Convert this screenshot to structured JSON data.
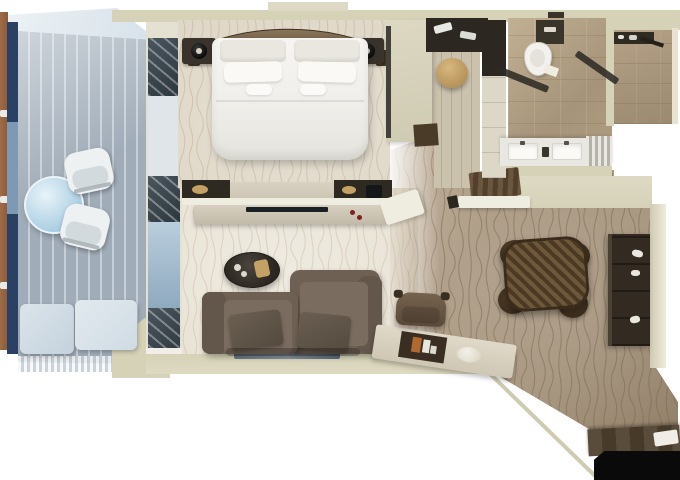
{
  "scene": {
    "type": "floor-plan",
    "subject": "one-bedroom suite floor plan, top-down 3D rendering",
    "rooms": [
      {
        "name": "balcony",
        "furniture": [
          "round-glass-table",
          "armchair",
          "armchair",
          "lounger-cushions",
          "plank-decking",
          "railing",
          "awning"
        ]
      },
      {
        "name": "bedroom",
        "furniture": [
          "double-bed",
          "curved-headboard",
          "pillows",
          "nightstand-left",
          "nightstand-right",
          "table-lamps",
          "dresser-console"
        ]
      },
      {
        "name": "walk-in-closet",
        "furniture": [
          "wardrobe-shelf",
          "round-ottoman",
          "wood-floor",
          "closet-doors"
        ]
      },
      {
        "name": "bathroom",
        "furniture": [
          "toilet",
          "double-vanity",
          "glass-shower-partitions",
          "shower-room",
          "shower-fittings"
        ]
      },
      {
        "name": "living-room",
        "furniture": [
          "media-console",
          "tv",
          "oval-coffee-table",
          "two-seat-sofa",
          "throw-pillows",
          "writing-desk",
          "desk-chair",
          "serving-tray"
        ]
      },
      {
        "name": "dining-area",
        "furniture": [
          "round-dining-table",
          "dining-chair",
          "dining-chair",
          "dining-chair",
          "dining-chair",
          "bar-cabinet"
        ]
      },
      {
        "name": "entry",
        "furniture": [
          "wood-threshold",
          "door-mat",
          "doorway"
        ]
      }
    ]
  },
  "palette": {
    "white": "#ffffff",
    "wall": "#d6d2b8",
    "wall_light": "#ddd9c4",
    "awning": "#edf2f5",
    "railing": "#a06c48",
    "door_blue": "#2b4163",
    "glass_mid": "#7d99b4",
    "deck": "#a0acb8",
    "deck_light": "#c6cfd7",
    "glass_table_hi": "#e8f3f9",
    "glass_table": "#a9cde2",
    "chair_white": "#eef1f2",
    "chair_seat": "#d3dade",
    "lounger_a": "#c4d2dd",
    "lounger_b": "#cfdbe4",
    "win_dark_a": "#4a565e",
    "win_dark_b": "#2c363d",
    "win_glass": "#dfe5e8",
    "win_blue_a": "#b9cedd",
    "win_blue_b": "#8fa9bf",
    "sill": "#f0eee6",
    "bedroom_carpet": "#ded6c5",
    "bedroom_wave": "#bfb099",
    "living_carpet": "#e8e2d4",
    "living_wave": "#cbbda6",
    "corridor_a": "#c4b39d",
    "corridor_b": "#a5937c",
    "corridor_wave": "#79684f",
    "headboard_a": "#8a7659",
    "headboard_b": "#4e3f2c",
    "nightstand": "#3a332b",
    "lamp_hi": "#d9d2c4",
    "bed_hi": "#f6f5f2",
    "bed_lo": "#e5e3dc",
    "pillow_hi": "#faf9f6",
    "pillow_lo": "#eae7e0",
    "dresser_dark": "#2f2a21",
    "counter_light": "#d8d1c1",
    "counter_white": "#efece0",
    "tv": "#1a2026",
    "accent_red": "#7e2020",
    "tray_tan": "#c4a266",
    "rwall_a": "#ddd8c2",
    "rwall_b": "#cfcab2",
    "wall_dark_edge": "#42413a",
    "wall_wood_dark": "#4a3b29",
    "door_wood_a": "#6a573f",
    "door_wood_b": "#52402c",
    "plank_a": "#cbc2ae",
    "plank_b": "#b5aa93",
    "closet_dark": "#2c2720",
    "closet_door": "#dcd7c6",
    "ottoman_a": "#d7b87e",
    "ottoman_b": "#b28f58",
    "marble_a": "#c2b094",
    "marble_b": "#a6947a",
    "fixture_dark": "#3a352b",
    "white_fixture": "#f2f1ed",
    "vanity": "#e9e7e1",
    "sink": "#fbfaf7",
    "glass_dark": "#2e2b25",
    "stripe_a": "#e8e7e2",
    "stripe_b": "#b5b2a9",
    "sofa": "#6e6053",
    "sofa_dark": "#63564a",
    "sofa_seat": "#7a6c5e",
    "sofa_pillow_a": "#6b5f52",
    "sofa_pillow_b": "#544a3f",
    "coffee_a": "#4a443c",
    "coffee_b": "#2a2620",
    "console_a": "#d7cfbf",
    "console_b": "#c3bba9",
    "desk_a": "#e0d9c9",
    "desk_b": "#cfc7b4",
    "blotter": "#3a2e23",
    "card_orange": "#b06a31",
    "card_white": "#e8e5dd",
    "chair_brown_a": "#75634f",
    "chair_brown_b": "#5a4938",
    "dining_a": "#6e583a",
    "dining_b": "#4c3923",
    "dining_edge": "#3a2c1b",
    "dining_chair_a": "#5d4730",
    "dining_chair_b": "#3c2d1c",
    "cabinet": "#332b21",
    "cabinet_hi": "#4a4034",
    "bottle": "#e9e7df",
    "entry_wood_a": "#5a4c3a",
    "entry_wood_b": "#473a2a",
    "entry_black": "#0a0a0a",
    "paper": "#efede6",
    "edge_line": "#cfcbb2",
    "art_a": "#6a7683",
    "art_b": "#8a95a1"
  }
}
